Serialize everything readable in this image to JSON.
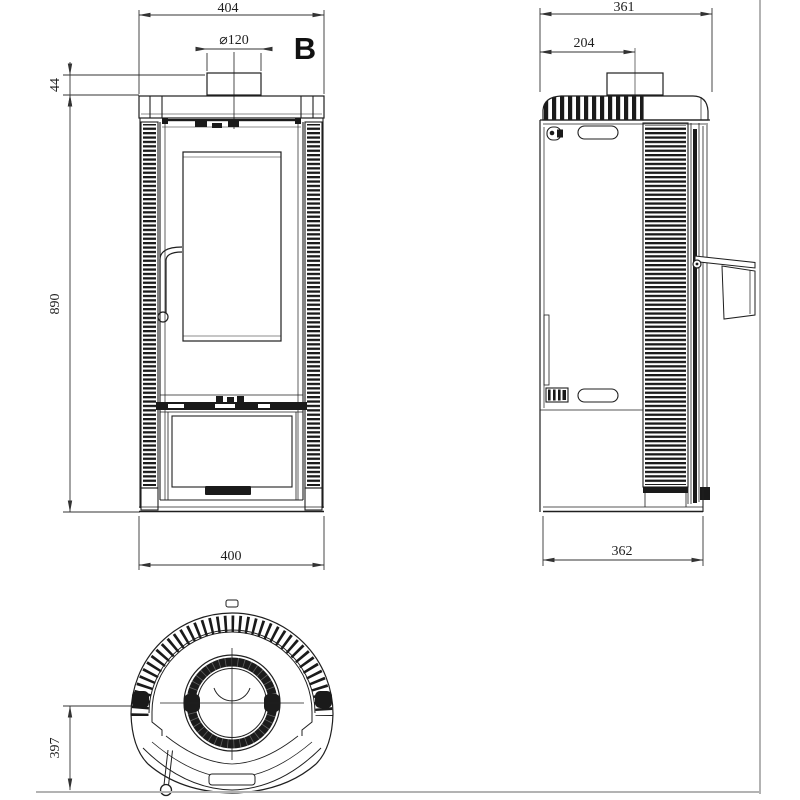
{
  "title": "Stove technical drawing, three views",
  "views": {
    "front": {
      "label": "B",
      "dims": {
        "top_width": "404",
        "flue_diameter": "⌀120",
        "flue_collar_height": "44",
        "body_height": "890",
        "bottom_width": "400"
      }
    },
    "side": {
      "dims": {
        "top_width": "361",
        "flue_offset": "204",
        "bottom_width": "362"
      }
    },
    "top": {
      "dims": {
        "depth_to_front": "397"
      }
    }
  },
  "colors": {
    "line": "#1f1f1f",
    "dark_fill": "#1a1a1a",
    "dimension_line": "#333333",
    "sheet_border": "#b3b3b3",
    "background": "#ffffff"
  }
}
